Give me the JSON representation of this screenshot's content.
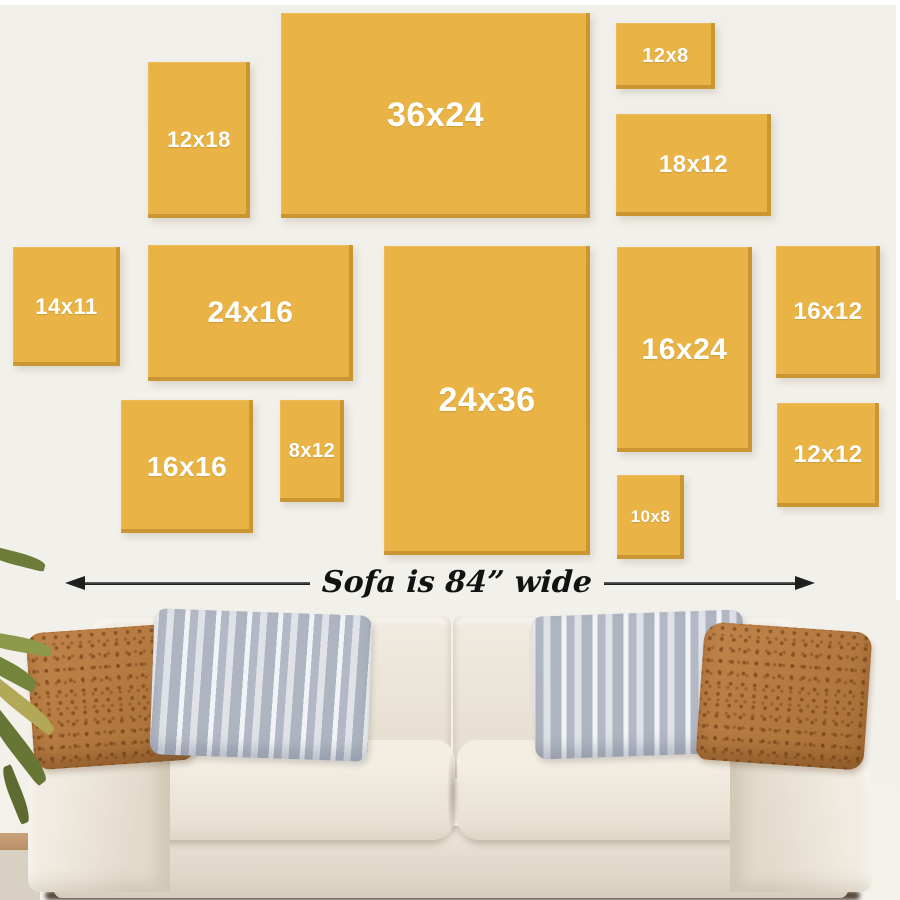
{
  "gallery": {
    "panels": [
      {
        "id": "12x18",
        "label": "12x18"
      },
      {
        "id": "36x24",
        "label": "36x24"
      },
      {
        "id": "12x8",
        "label": "12x8"
      },
      {
        "id": "18x12",
        "label": "18x12"
      },
      {
        "id": "14x11",
        "label": "14x11"
      },
      {
        "id": "24x16",
        "label": "24x16"
      },
      {
        "id": "24x36",
        "label": "24x36"
      },
      {
        "id": "16x24",
        "label": "16x24"
      },
      {
        "id": "16x12",
        "label": "16x12"
      },
      {
        "id": "16x16",
        "label": "16x16"
      },
      {
        "id": "8x12",
        "label": "8x12"
      },
      {
        "id": "10x8",
        "label": "10x8"
      },
      {
        "id": "12x12",
        "label": "12x12"
      }
    ],
    "colors": {
      "canvas": "#e9b445",
      "canvas_edge": "#c8962f",
      "wall": "#f1efe9",
      "panel_label": "#ffffff",
      "annotation_text": "#121212",
      "sofa_fabric": "#eae3d6",
      "rust_pillow": "#b67c42",
      "gray_pillow": "#c8ccd5"
    }
  },
  "dimension": {
    "label": "Sofa is 84” wide"
  }
}
